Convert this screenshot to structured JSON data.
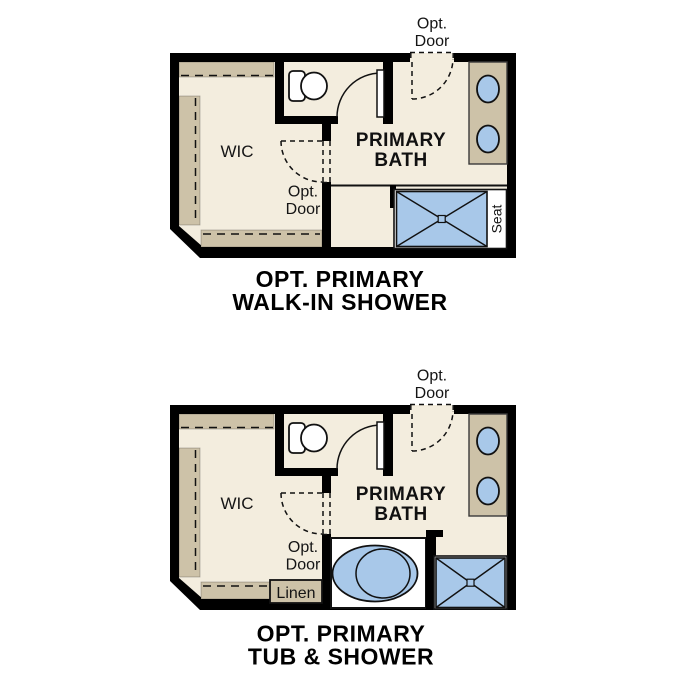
{
  "figure": {
    "type": "floor-plan-options",
    "background": "#ffffff"
  },
  "colors": {
    "wall": "#000000",
    "floor": "#f3edde",
    "cabinetry_tan": "#cdc2a8",
    "fixture_blue": "#a8c8e9",
    "outline": "#111111",
    "text": "#000000"
  },
  "plans": [
    {
      "id": "walk-in-shower-option",
      "title_line1": "OPT. PRIMARY",
      "title_line2": "WALK-IN SHOWER",
      "labels": {
        "wic": "WIC",
        "bath_line1": "PRIMARY",
        "bath_line2": "BATH",
        "opt_door_top_l1": "Opt.",
        "opt_door_top_l2": "Door",
        "opt_door_mid_l1": "Opt.",
        "opt_door_mid_l2": "Door",
        "seat": "Seat"
      }
    },
    {
      "id": "tub-and-shower-option",
      "title_line1": "OPT. PRIMARY",
      "title_line2": "TUB & SHOWER",
      "labels": {
        "wic": "WIC",
        "bath_line1": "PRIMARY",
        "bath_line2": "BATH",
        "opt_door_top_l1": "Opt.",
        "opt_door_top_l2": "Door",
        "opt_door_mid_l1": "Opt.",
        "opt_door_mid_l2": "Door",
        "linen": "Linen"
      }
    }
  ]
}
